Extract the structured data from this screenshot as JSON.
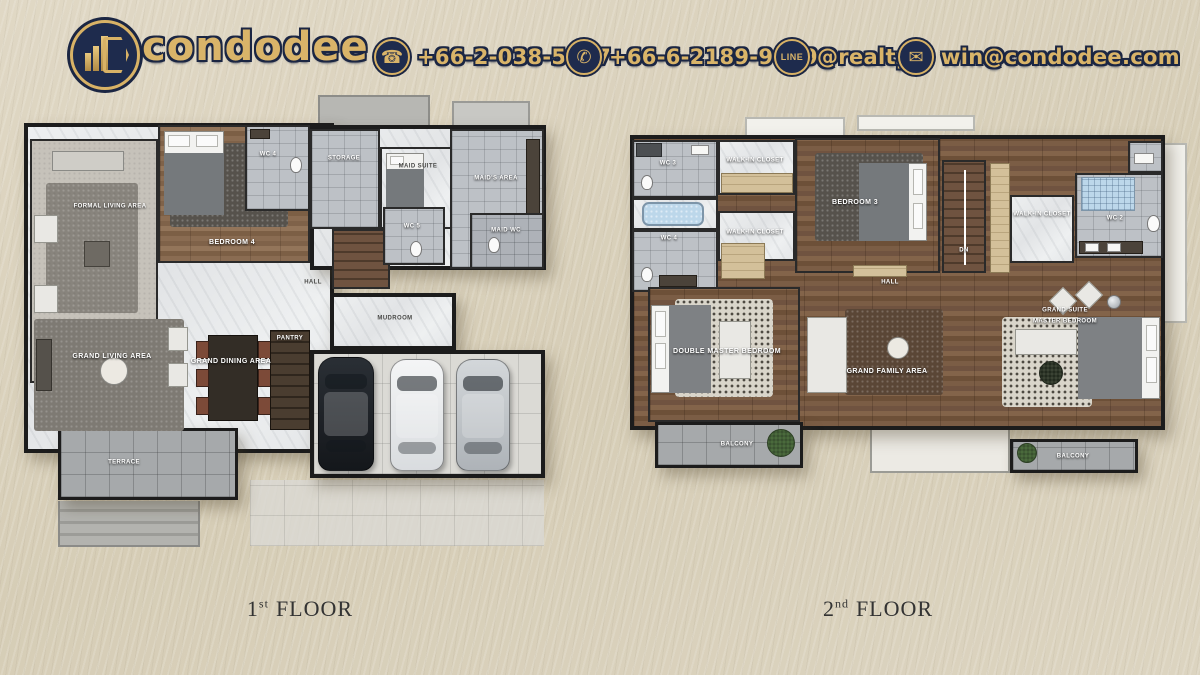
{
  "header": {
    "brand": "condodee",
    "contacts": [
      {
        "name": "phone",
        "glyph": "☎",
        "value": "+66-2-038-5897"
      },
      {
        "name": "whatsapp",
        "glyph": "✆",
        "value": "+66-6-2189-9659"
      },
      {
        "name": "line",
        "icon_text": "LINE",
        "value": "@realty"
      },
      {
        "name": "email",
        "glyph": "✉",
        "value": "win@condodee.com"
      }
    ]
  },
  "floor1": {
    "caption": {
      "num": "1",
      "ord": "st",
      "word": "FLOOR"
    },
    "rooms": {
      "formal_living": "FORMAL LIVING AREA",
      "bedroom4": "BEDROOM 4",
      "wc4": "WC 4",
      "storage": "STORAGE",
      "maid_suite": "MAID SUITE",
      "maids_area": "MAID'S AREA",
      "wc5": "WC 5",
      "maid_wc": "MAID WC",
      "hall": "HALL",
      "mudroom": "MUDROOM",
      "pantry": "PANTRY",
      "grand_living": "GRAND LIVING AREA",
      "grand_dining": "GRAND DINING AREA",
      "terrace": "TERRACE"
    }
  },
  "floor2": {
    "caption": {
      "num": "2",
      "ord": "nd",
      "word": "FLOOR"
    },
    "rooms": {
      "wc3": "WC 3",
      "wc4": "WC 4",
      "walkin_closet_top": "WALK-IN CLOSET",
      "walkin_closet_mid": "WALK-IN CLOSET",
      "walkin_closet_right": "WALK-IN CLOSET",
      "bedroom3": "BEDROOM 3",
      "dn": "DN",
      "hall": "HALL",
      "wc2": "WC 2",
      "double_master": "DOUBLE MASTER BEDROOM",
      "grand_family": "GRAND FAMILY AREA",
      "grand_suite_l1": "GRAND SUITE",
      "grand_suite_l2": "MASTER BEDROOM",
      "balcony_left": "BALCONY",
      "balcony_right": "BALCONY"
    }
  }
}
